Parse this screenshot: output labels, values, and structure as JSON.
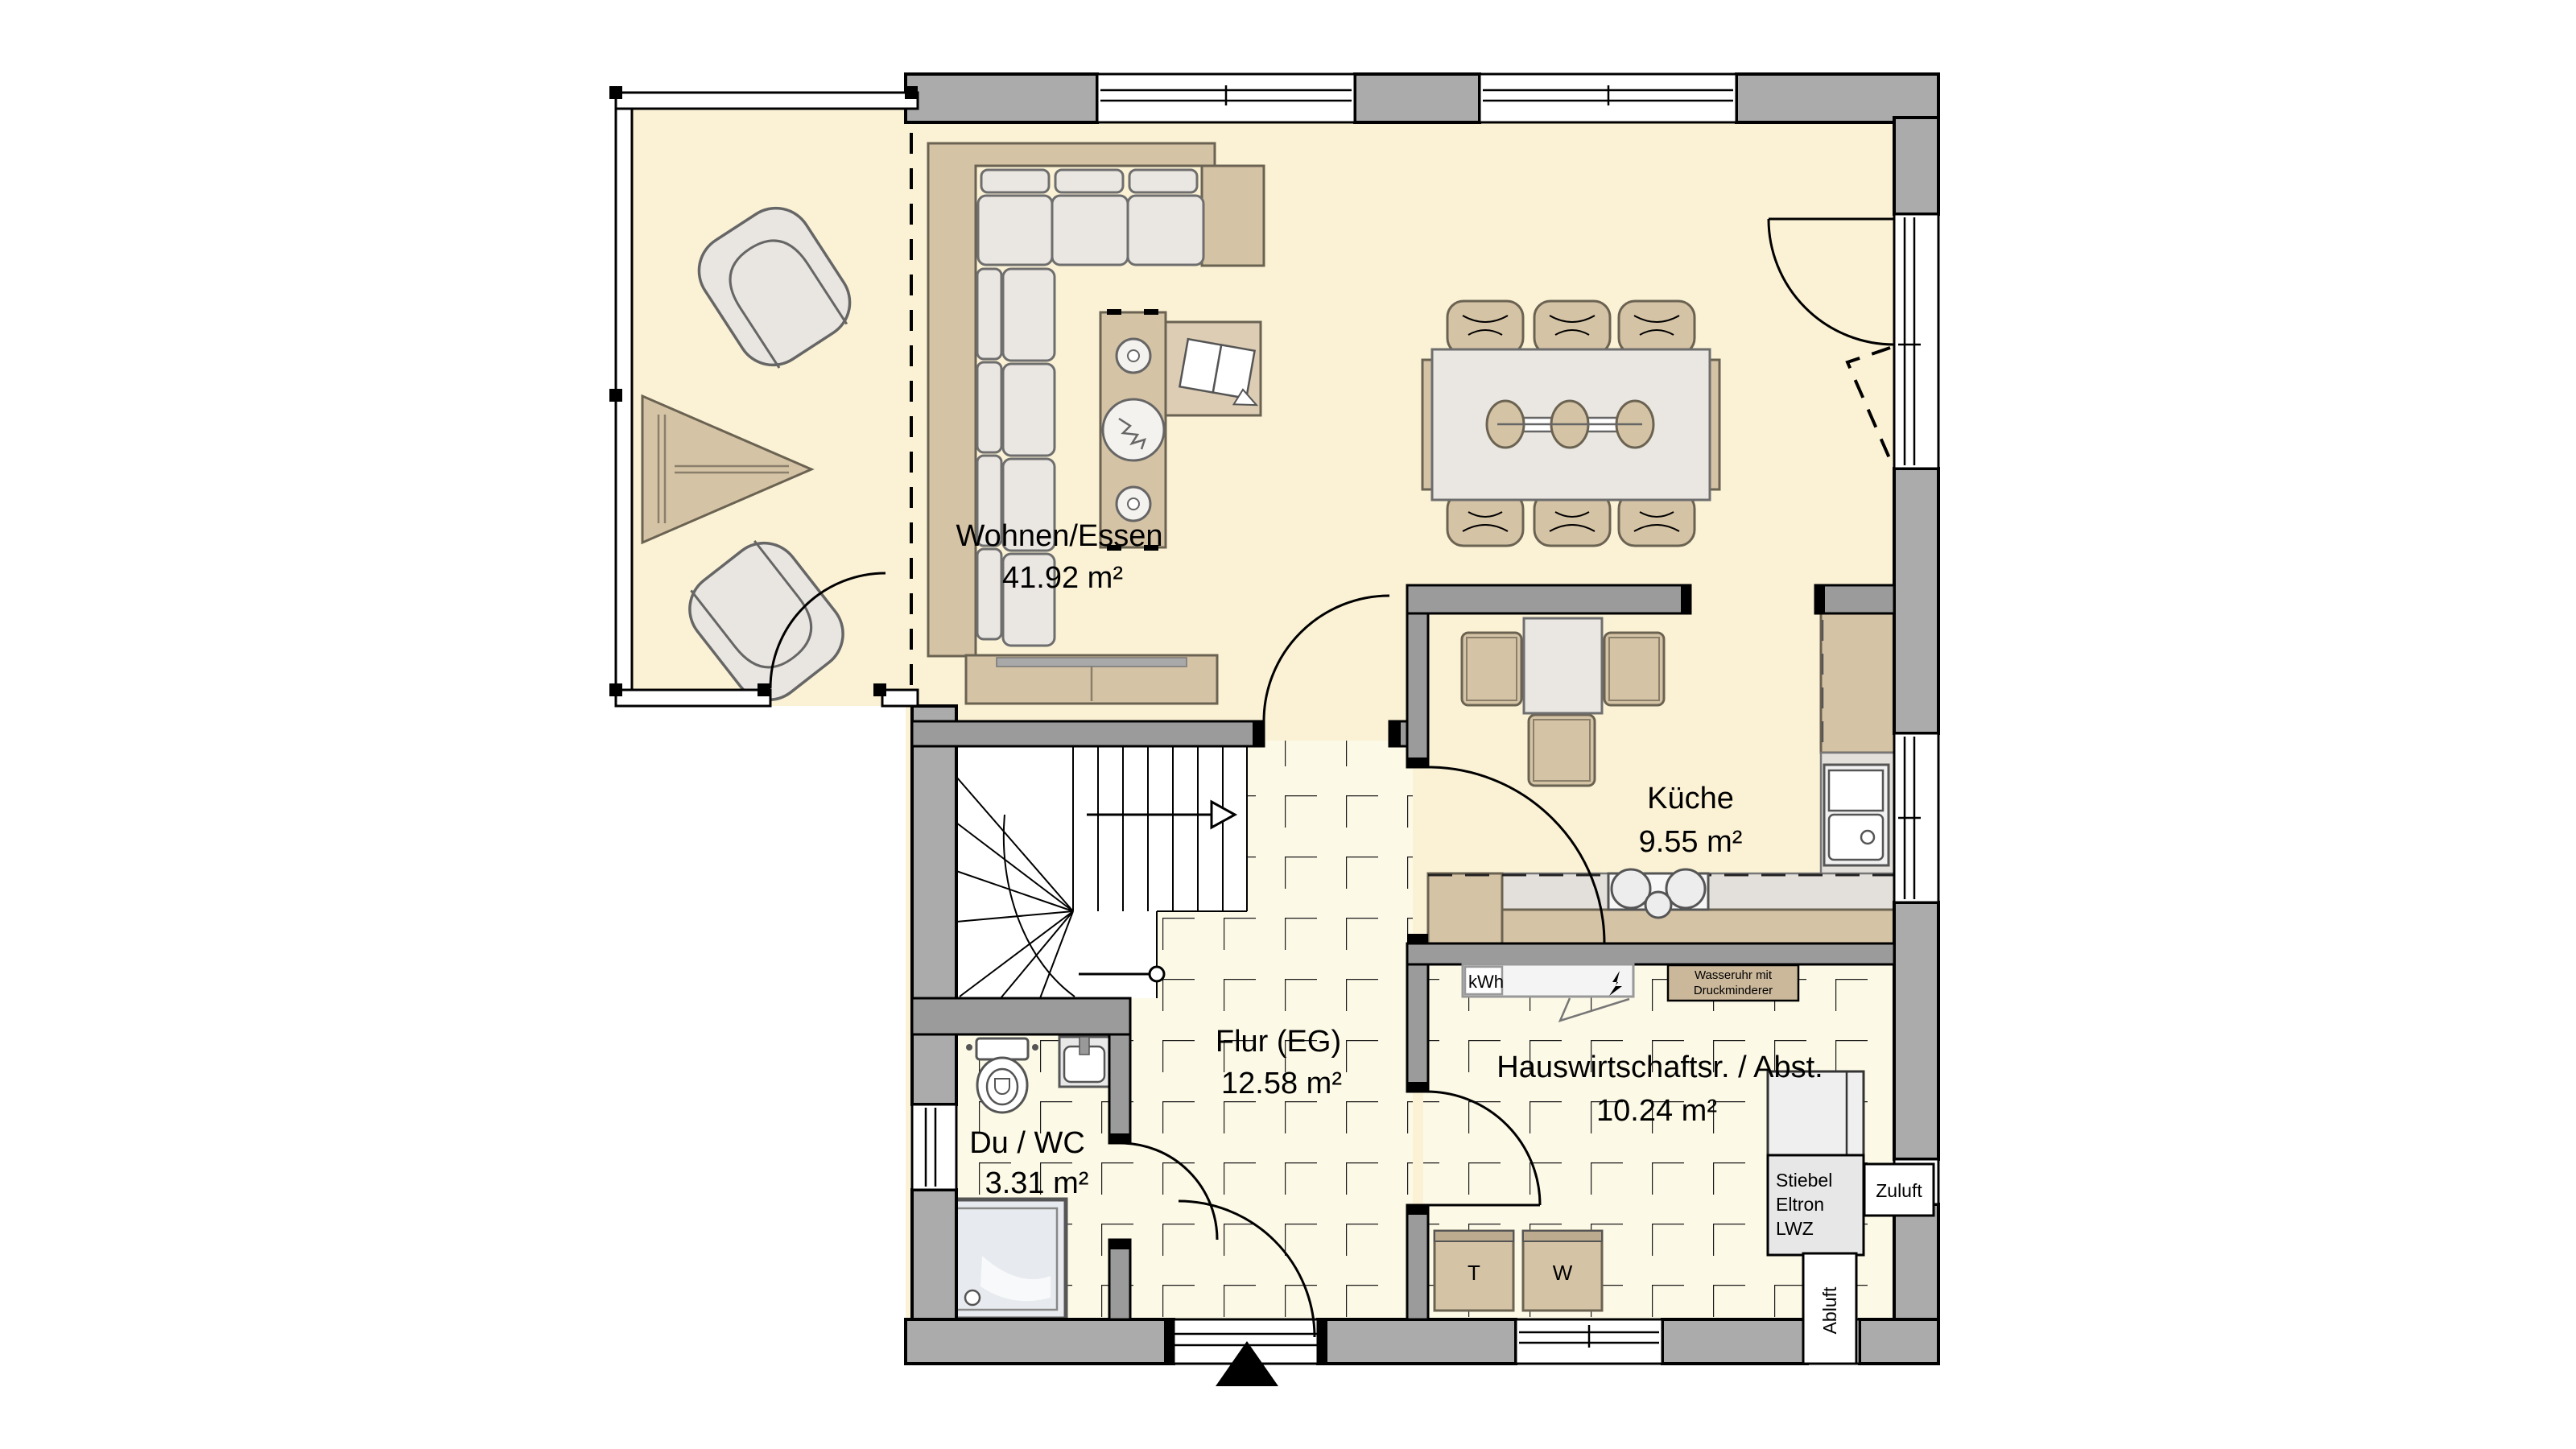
{
  "plan_title": "Erdgeschoss Grundriss",
  "rooms": {
    "wohnen_essen": {
      "label": "Wohnen/Essen",
      "area": "41.92 m²"
    },
    "kueche": {
      "label": "Küche",
      "area": "9.55 m²"
    },
    "flur": {
      "label": "Flur (EG)",
      "area": "12.58 m²"
    },
    "du_wc": {
      "label": "Du / WC",
      "area": "3.31 m²"
    },
    "hwr": {
      "label": "Hauswirtschaftsr. / Abst.",
      "area": "10.24 m²"
    }
  },
  "equipment": {
    "kwh": "kWh",
    "wasseruhr_line1": "Wasseruhr mit",
    "wasseruhr_line2": "Druckminderer",
    "stiebel_line1": "Stiebel",
    "stiebel_line2": "Eltron",
    "stiebel_line3": "LWZ",
    "zuluft": "Zuluft",
    "abluft": "Abluft",
    "dryer": "T",
    "washer": "W"
  },
  "colors": {
    "wall": "#ABABAB",
    "wall2": "#9B9B9B",
    "floor": "#FBF2D6",
    "tile-floor": "#FCF9E6",
    "tan": "#D5C3A5",
    "lite": "#EAE6E1",
    "counter": "#E3DFDA"
  }
}
